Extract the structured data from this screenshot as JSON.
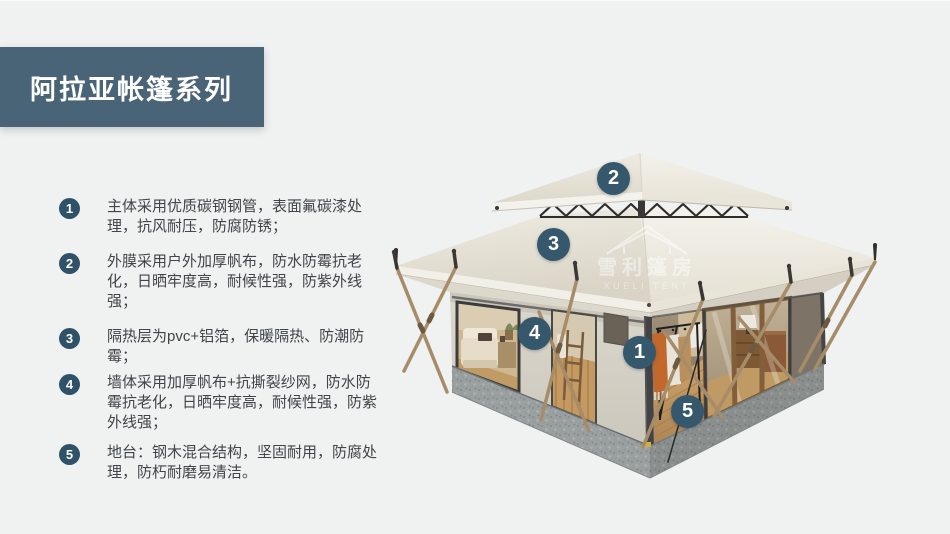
{
  "title": "阿拉亚帐篷系列",
  "features": [
    {
      "num": "1",
      "text": "主体采用优质碳钢钢管，表面氟碳漆处理，抗风耐压，防腐防锈；"
    },
    {
      "num": "2",
      "text": "外膜采用户外加厚帆布，防水防霉抗老化，日晒牢度高，耐候性强，防紫外线强；"
    },
    {
      "num": "3",
      "text": "隔热层为pvc+铝箔，保暖隔热、防潮防霉；"
    },
    {
      "num": "4",
      "text": "墙体采用加厚帆布+抗撕裂纱网，防水防霉抗老化，日晒牢度高，耐候性强，防紫外线强；"
    },
    {
      "num": "5",
      "text": "地台：钢木混合结构，坚固耐用，防腐处理，防朽耐磨易清洁。"
    }
  ],
  "callouts": [
    {
      "num": "1"
    },
    {
      "num": "2"
    },
    {
      "num": "3"
    },
    {
      "num": "4"
    },
    {
      "num": "5"
    }
  ],
  "watermark": {
    "zh": "雪利篷房",
    "en": "XUELI TENT"
  },
  "colors": {
    "background": "#f0f1f1",
    "banner": "#4a6477",
    "list_badge": "#2f5268",
    "callout_badge": "#36586d",
    "text": "#3f4548"
  }
}
